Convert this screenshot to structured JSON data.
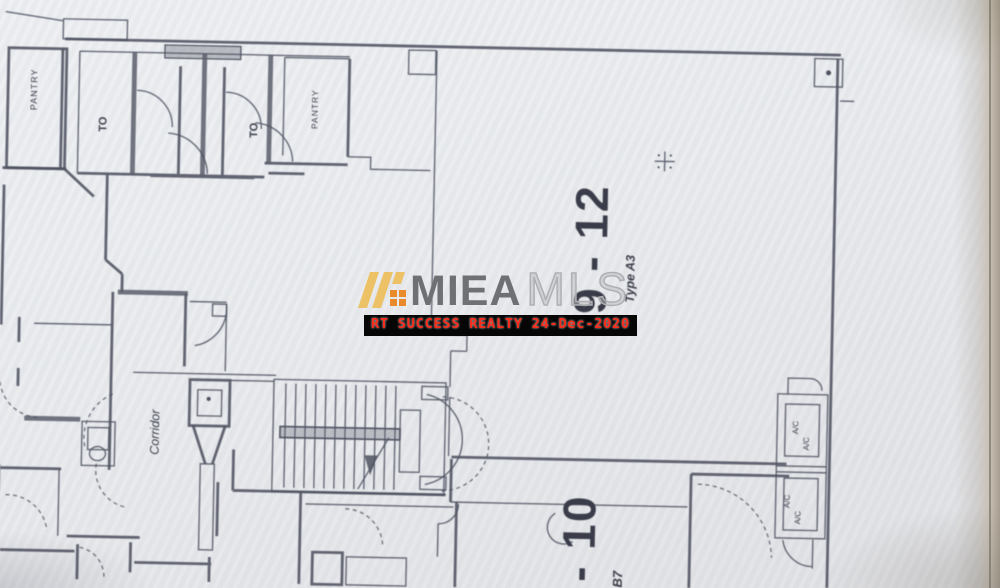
{
  "floorplan": {
    "ink_color": "#4e5260",
    "paper_color": "#e9eaed",
    "units": {
      "main": {
        "number": "9 - 12",
        "type_label": "Type A3"
      },
      "bottom": {
        "number": "- 10",
        "type_label": "B7"
      }
    },
    "labels": {
      "pantry_left": "PANTRY",
      "pantry_top": "PANTRY",
      "toilet_left": "TO",
      "toilet_right": "TO",
      "corridor": "Corridor",
      "ac": "A/C"
    }
  },
  "watermark": {
    "brand_bold": "MIEA",
    "brand_light": "MLS",
    "banner_text": "RT SUCCESS REALTY 24-Dec-2020",
    "colors": {
      "gold": "#edc266",
      "orange": "#e98a2d",
      "brand_bold": "#6f7074",
      "brand_light": "#b0b0b3",
      "banner_bg": "#060606",
      "banner_text": "#fb2b19"
    }
  }
}
